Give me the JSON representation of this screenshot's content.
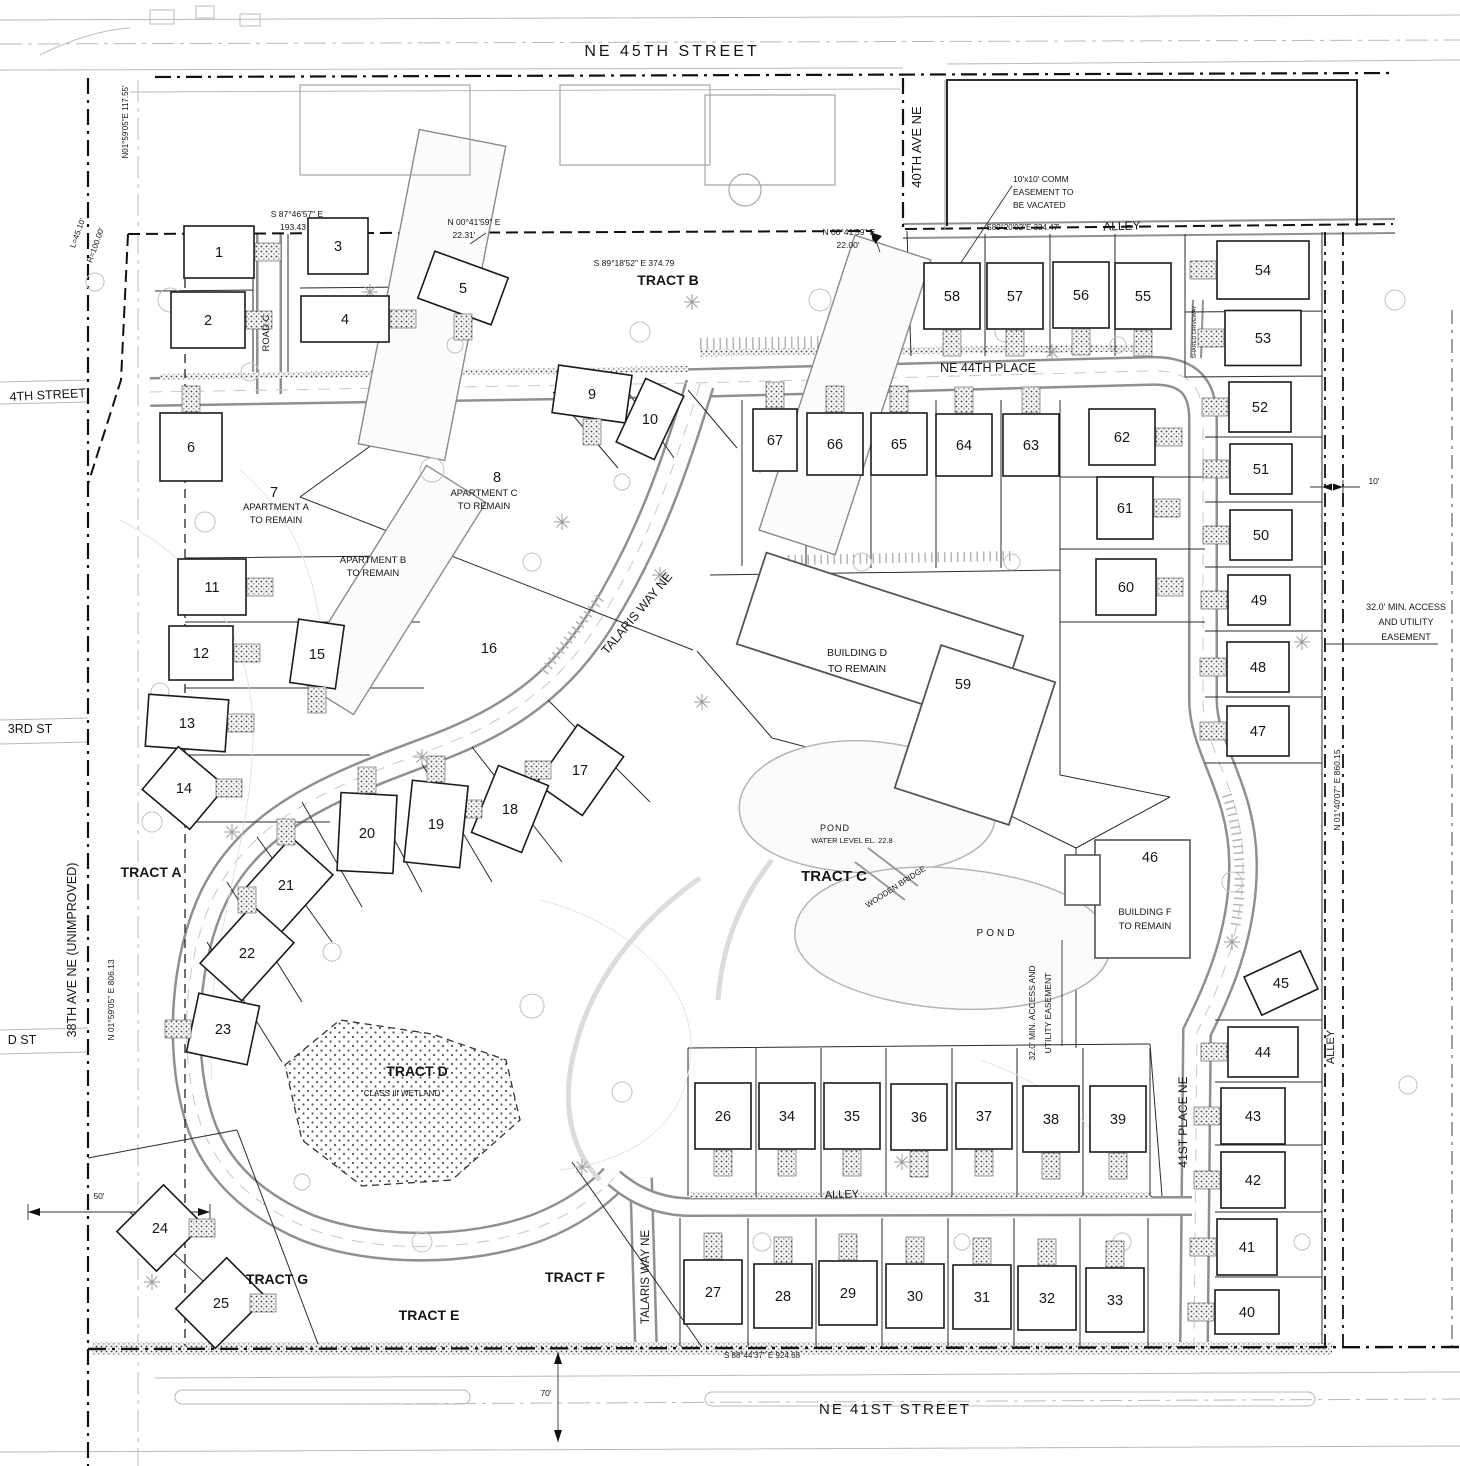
{
  "lots_format": "[lot_number, center_x, center_y, footprint_w, footprint_h, rotation_deg, driveway_side]",
  "lots": [
    [
      1,
      219,
      252,
      70,
      52,
      0,
      "e"
    ],
    [
      2,
      208,
      320,
      74,
      56,
      0,
      "e"
    ],
    [
      3,
      338,
      246,
      60,
      56,
      0,
      ""
    ],
    [
      4,
      345,
      319,
      88,
      46,
      0,
      "e"
    ],
    [
      5,
      463,
      288,
      78,
      50,
      20,
      "s"
    ],
    [
      6,
      191,
      447,
      62,
      68,
      0,
      "n"
    ],
    [
      7,
      274,
      492,
      0,
      0,
      0,
      ""
    ],
    [
      8,
      497,
      477,
      0,
      0,
      0,
      ""
    ],
    [
      9,
      592,
      394,
      74,
      48,
      8,
      "s"
    ],
    [
      10,
      650,
      419,
      42,
      70,
      25,
      ""
    ],
    [
      11,
      212,
      587,
      68,
      56,
      0,
      "e"
    ],
    [
      12,
      201,
      653,
      64,
      54,
      0,
      "e"
    ],
    [
      13,
      187,
      723,
      80,
      52,
      4,
      "e"
    ],
    [
      14,
      184,
      788,
      62,
      56,
      40,
      "e"
    ],
    [
      15,
      317,
      654,
      46,
      64,
      8,
      "s"
    ],
    [
      16,
      489,
      648,
      0,
      0,
      0,
      ""
    ],
    [
      17,
      580,
      770,
      56,
      72,
      35,
      "w"
    ],
    [
      18,
      510,
      809,
      54,
      72,
      22,
      "w"
    ],
    [
      19,
      436,
      824,
      56,
      82,
      6,
      "n"
    ],
    [
      20,
      367,
      833,
      56,
      78,
      3,
      "n"
    ],
    [
      21,
      286,
      885,
      56,
      78,
      42,
      "n"
    ],
    [
      22,
      247,
      953,
      56,
      78,
      42,
      "n"
    ],
    [
      23,
      223,
      1029,
      62,
      60,
      12,
      "w"
    ],
    [
      24,
      160,
      1228,
      56,
      66,
      45,
      "e"
    ],
    [
      25,
      221,
      1303,
      56,
      72,
      45,
      "e"
    ],
    [
      26,
      723,
      1116,
      56,
      66,
      0,
      "s"
    ],
    [
      27,
      713,
      1292,
      58,
      64,
      0,
      "n"
    ],
    [
      28,
      783,
      1296,
      58,
      64,
      0,
      "n"
    ],
    [
      29,
      848,
      1293,
      58,
      64,
      0,
      "n"
    ],
    [
      30,
      915,
      1296,
      58,
      64,
      0,
      "n"
    ],
    [
      31,
      982,
      1297,
      58,
      64,
      0,
      "n"
    ],
    [
      32,
      1047,
      1298,
      58,
      64,
      0,
      "n"
    ],
    [
      33,
      1115,
      1300,
      58,
      64,
      0,
      "n"
    ],
    [
      34,
      787,
      1116,
      56,
      66,
      0,
      "s"
    ],
    [
      35,
      852,
      1116,
      56,
      66,
      0,
      "s"
    ],
    [
      36,
      919,
      1117,
      56,
      66,
      0,
      "s"
    ],
    [
      37,
      984,
      1116,
      56,
      66,
      0,
      "s"
    ],
    [
      38,
      1051,
      1119,
      56,
      66,
      0,
      "s"
    ],
    [
      39,
      1118,
      1119,
      56,
      66,
      0,
      "s"
    ],
    [
      40,
      1247,
      1312,
      64,
      44,
      0,
      "w"
    ],
    [
      41,
      1247,
      1247,
      60,
      56,
      0,
      "w"
    ],
    [
      42,
      1253,
      1180,
      64,
      56,
      0,
      "w"
    ],
    [
      43,
      1253,
      1116,
      64,
      56,
      0,
      "w"
    ],
    [
      44,
      1263,
      1052,
      70,
      50,
      0,
      "w"
    ],
    [
      45,
      1281,
      983,
      62,
      42,
      -25,
      ""
    ],
    [
      46,
      1150,
      857,
      0,
      0,
      0,
      ""
    ],
    [
      47,
      1258,
      731,
      62,
      50,
      0,
      "w"
    ],
    [
      48,
      1258,
      667,
      62,
      50,
      0,
      "w"
    ],
    [
      49,
      1259,
      600,
      62,
      50,
      0,
      "w"
    ],
    [
      50,
      1261,
      535,
      62,
      50,
      0,
      "w"
    ],
    [
      51,
      1261,
      469,
      62,
      50,
      0,
      "w"
    ],
    [
      52,
      1260,
      407,
      62,
      50,
      0,
      "w"
    ],
    [
      53,
      1263,
      338,
      76,
      55,
      0,
      "w"
    ],
    [
      54,
      1263,
      270,
      92,
      58,
      0,
      "w"
    ],
    [
      55,
      1143,
      296,
      56,
      66,
      0,
      "s"
    ],
    [
      56,
      1081,
      295,
      56,
      66,
      0,
      "s"
    ],
    [
      57,
      1015,
      296,
      56,
      66,
      0,
      "s"
    ],
    [
      58,
      952,
      296,
      56,
      66,
      0,
      "s"
    ],
    [
      59,
      963,
      684,
      0,
      0,
      0,
      ""
    ],
    [
      60,
      1126,
      587,
      60,
      56,
      0,
      "e"
    ],
    [
      61,
      1125,
      508,
      56,
      62,
      0,
      "e"
    ],
    [
      62,
      1122,
      437,
      66,
      56,
      0,
      "e"
    ],
    [
      63,
      1031,
      445,
      56,
      62,
      0,
      "n"
    ],
    [
      64,
      964,
      445,
      56,
      62,
      0,
      "n"
    ],
    [
      65,
      899,
      444,
      56,
      62,
      0,
      "n"
    ],
    [
      66,
      835,
      444,
      56,
      62,
      0,
      "n"
    ],
    [
      67,
      775,
      440,
      44,
      62,
      0,
      "n"
    ]
  ],
  "labels": {
    "streets": [
      {
        "t": "NE 45TH STREET",
        "x": 672,
        "y": 56,
        "s": 16,
        "ls": 3
      },
      {
        "t": "40TH AVE NE",
        "x": 921,
        "y": 147,
        "s": 13,
        "r": -90
      },
      {
        "t": "ALLEY",
        "x": 1122,
        "y": 230,
        "s": 12,
        "r": -2
      },
      {
        "t": "NE 44TH PLACE",
        "x": 988,
        "y": 372,
        "s": 12.5
      },
      {
        "t": "TALARIS WAY NE",
        "x": 640,
        "y": 616,
        "s": 12.5,
        "r": -50
      },
      {
        "t": "TALARIS WAY NE",
        "x": 649,
        "y": 1277,
        "s": 11.5,
        "r": -90
      },
      {
        "t": "ROAD C",
        "x": 269,
        "y": 333,
        "s": 9.5,
        "r": -90
      },
      {
        "t": "41ST PLACE NE",
        "x": 1187,
        "y": 1122,
        "s": 12,
        "r": -90
      },
      {
        "t": "ALLEY",
        "x": 842,
        "y": 1198,
        "s": 11,
        "r": -2
      },
      {
        "t": "ALLEY",
        "x": 1334,
        "y": 1047,
        "s": 11,
        "r": -90
      },
      {
        "t": "NE 41ST STREET",
        "x": 895,
        "y": 1414,
        "s": 15,
        "ls": 2
      },
      {
        "t": "4TH STREET",
        "x": 48,
        "y": 399,
        "s": 12.5,
        "r": -3
      },
      {
        "t": "3RD ST",
        "x": 30,
        "y": 733,
        "s": 12.5
      },
      {
        "t": "D ST",
        "x": 22,
        "y": 1044,
        "s": 12.5
      },
      {
        "t": "38TH AVE NE (UNIMPROVED)",
        "x": 76,
        "y": 950,
        "s": 12.5,
        "r": -90
      }
    ],
    "tracts": [
      {
        "t": "TRACT A",
        "x": 151,
        "y": 877
      },
      {
        "t": "TRACT B",
        "x": 668,
        "y": 285
      },
      {
        "t": "TRACT C",
        "x": 834,
        "y": 881,
        "s": 15
      },
      {
        "t": "TRACT D",
        "x": 417,
        "y": 1076
      },
      {
        "t": "TRACT E",
        "x": 429,
        "y": 1320
      },
      {
        "t": "TRACT F",
        "x": 575,
        "y": 1282
      },
      {
        "t": "TRACT G",
        "x": 277,
        "y": 1284
      }
    ],
    "buildings": [
      {
        "t": "APARTMENT A",
        "x": 276,
        "y": 510
      },
      {
        "t": "TO REMAIN",
        "x": 276,
        "y": 523
      },
      {
        "t": "APARTMENT B",
        "x": 373,
        "y": 563
      },
      {
        "t": "TO REMAIN",
        "x": 373,
        "y": 576
      },
      {
        "t": "APARTMENT C",
        "x": 484,
        "y": 496
      },
      {
        "t": "TO REMAIN",
        "x": 484,
        "y": 509
      },
      {
        "t": "BUILDING D",
        "x": 857,
        "y": 656,
        "s": 10.5
      },
      {
        "t": "TO REMAIN",
        "x": 857,
        "y": 672,
        "s": 10.5
      },
      {
        "t": "BUILDING F",
        "x": 1145,
        "y": 915
      },
      {
        "t": "TO REMAIN",
        "x": 1145,
        "y": 929
      }
    ],
    "water": [
      {
        "t": "POND",
        "x": 835,
        "y": 831,
        "ls": 1
      },
      {
        "t": "WATER LEVEL EL. 22.8",
        "x": 852,
        "y": 843,
        "s": 7.5
      },
      {
        "t": "POND",
        "x": 997,
        "y": 936,
        "s": 10,
        "ls": 3
      },
      {
        "t": "WOODEN BRIDGE",
        "x": 897,
        "y": 889,
        "s": 8,
        "r": -33
      }
    ],
    "dims": [
      {
        "t": "N01°59'05\"E  117.55'",
        "x": 128,
        "y": 122,
        "r": -90,
        "s": 8
      },
      {
        "t": "L=45.10'",
        "x": 80,
        "y": 234,
        "r": -70,
        "s": 8
      },
      {
        "t": "R=100.00'",
        "x": 98,
        "y": 246,
        "r": -70,
        "s": 8
      },
      {
        "t": "S 87°46'57\" E",
        "x": 297,
        "y": 217
      },
      {
        "t": "193.43",
        "x": 293,
        "y": 230
      },
      {
        "t": "N 00°41'59\" E",
        "x": 474,
        "y": 225
      },
      {
        "t": "22.31'",
        "x": 464,
        "y": 238
      },
      {
        "t": "S 89°18'52\" E  374.79",
        "x": 634,
        "y": 266
      },
      {
        "t": "N 00°41'59\" E",
        "x": 849,
        "y": 235
      },
      {
        "t": "22.00'",
        "x": 848,
        "y": 248
      },
      {
        "t": "S89°20'02\"E  334.47'",
        "x": 1023,
        "y": 230,
        "s": 8
      },
      {
        "t": "10'x10' COMM",
        "x": 1013,
        "y": 182,
        "a": "start"
      },
      {
        "t": "EASEMENT TO",
        "x": 1013,
        "y": 195,
        "a": "start"
      },
      {
        "t": "BE VACATED",
        "x": 1013,
        "y": 208,
        "a": "start"
      },
      {
        "t": "N 01°59'05\" E  806.13",
        "x": 114,
        "y": 1000,
        "r": -90
      },
      {
        "t": "N 01°40'07\" E  860.15",
        "x": 1340,
        "y": 790,
        "r": -90
      },
      {
        "t": "32.0' MIN. ACCESS",
        "x": 1406,
        "y": 610,
        "s": 9
      },
      {
        "t": "AND UTILITY",
        "x": 1406,
        "y": 625,
        "s": 9
      },
      {
        "t": "EASEMENT",
        "x": 1406,
        "y": 640,
        "s": 9
      },
      {
        "t": "32.0' MIN. ACCESS AND",
        "x": 1035,
        "y": 1013,
        "r": -90
      },
      {
        "t": "UTILITY EASEMENT",
        "x": 1051,
        "y": 1013,
        "r": -90
      },
      {
        "t": "10'",
        "x": 1374,
        "y": 484
      },
      {
        "t": "50'",
        "x": 99,
        "y": 1199
      },
      {
        "t": "70'",
        "x": 546,
        "y": 1396
      },
      {
        "t": "S 88°44'37\" E  924.68",
        "x": 762,
        "y": 1358,
        "s": 8
      },
      {
        "t": "SHARED DRIVEWAY",
        "x": 1196,
        "y": 332,
        "r": -90,
        "s": 5.5,
        "c": "#8f8f8f"
      },
      {
        "t": "CLASS III WETLAND",
        "x": 402,
        "y": 1096,
        "s": 8,
        "c": "#6f6f6f"
      }
    ]
  },
  "colors": {
    "ink": "#161616",
    "gray": "#8f8f8f",
    "road_edge": "#909090",
    "stipple": "#444444"
  }
}
